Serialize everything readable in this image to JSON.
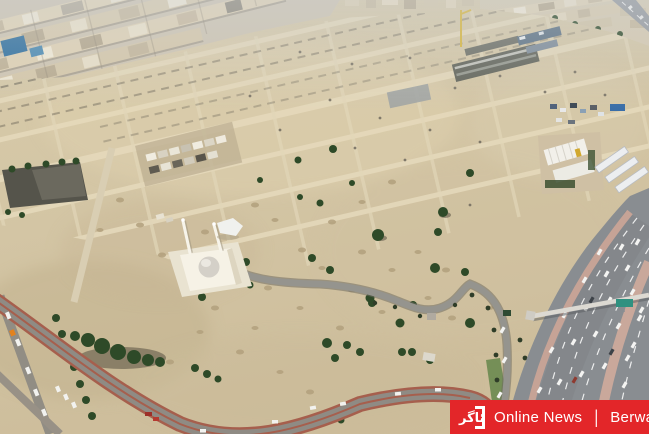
{
  "watermark": {
    "logo_text": "ئاگر",
    "title": "Online News",
    "separator": "|",
    "brand": "Berwaz",
    "background": "#e32629",
    "text_color": "#ffffff"
  },
  "palette": {
    "sand": "#d3c5a4",
    "sand_light": "#e6dabc",
    "plot_road": "#e6dabc",
    "highway_gray": "#898d91",
    "median_pink": "#c6a396",
    "asphalt_road": "#8f8b84",
    "curb_brown": "#a65f4d",
    "greenery": "#2e4a28",
    "city_beige": "#d9cbae",
    "blue_building": "#2f6f9e",
    "mosque_white": "#f6f2e6",
    "dome_gray": "#d4d0c8",
    "crane_yellow": "#d8b63c",
    "sign_teal": "#2f9180"
  }
}
